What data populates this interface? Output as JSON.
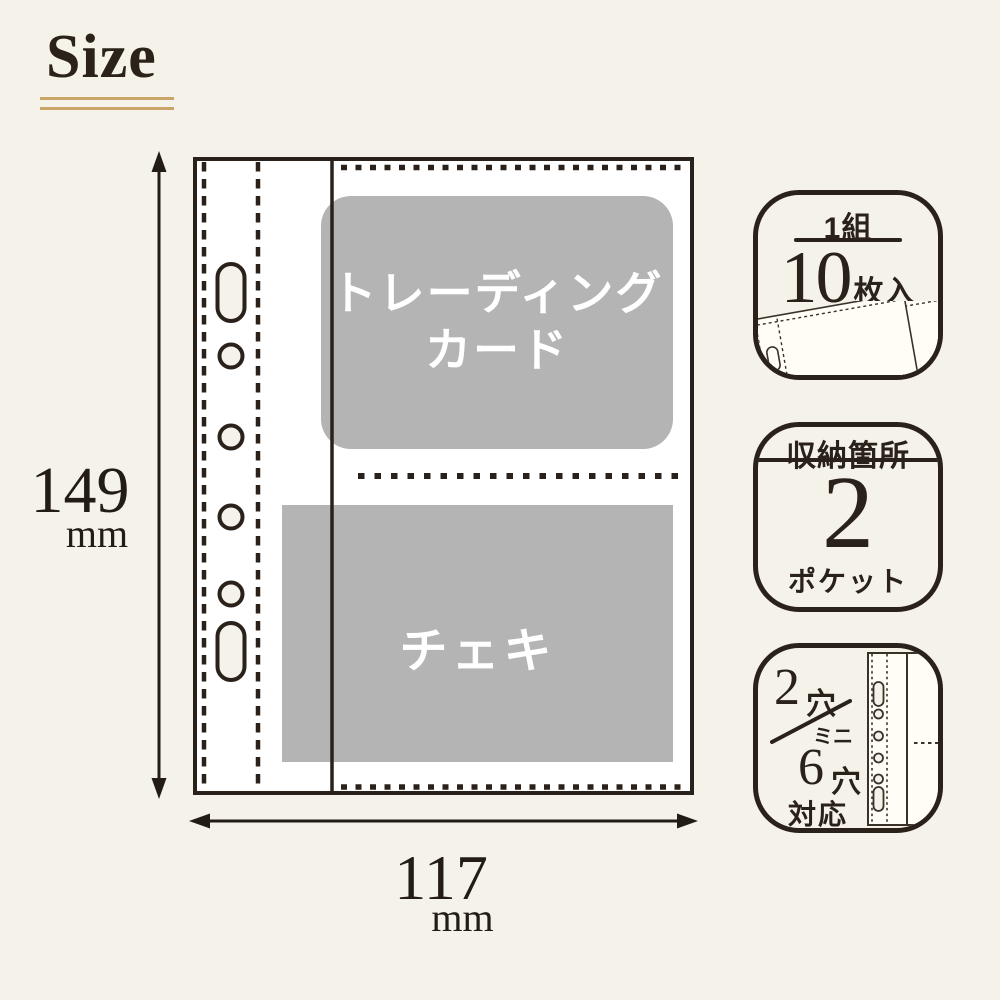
{
  "colors": {
    "background": "#f5f3e9",
    "ink": "#2a211b",
    "gold": "#c9a569",
    "pocket_gray": "#b4b4b4",
    "sheet_white": "#ffffff",
    "label_white": "#ffffff"
  },
  "title": {
    "text": "Size"
  },
  "dimensions": {
    "height": {
      "value": "149",
      "unit": "mm"
    },
    "width": {
      "value": "117",
      "unit": "mm"
    }
  },
  "sheet": {
    "top_pocket_label_line1": "トレーディング",
    "top_pocket_label_line2": "カード",
    "bottom_pocket_label": "チェキ"
  },
  "badges": {
    "pack": {
      "set_label": "1組",
      "count": "10",
      "count_unit": "枚入"
    },
    "storage": {
      "header": "収納箇所",
      "count": "2",
      "unit": "ポケット"
    },
    "compat": {
      "top_count": "2",
      "top_unit": "穴",
      "mini_label": "ミニ",
      "bottom_count": "6",
      "bottom_unit": "穴",
      "footer": "対応"
    }
  }
}
